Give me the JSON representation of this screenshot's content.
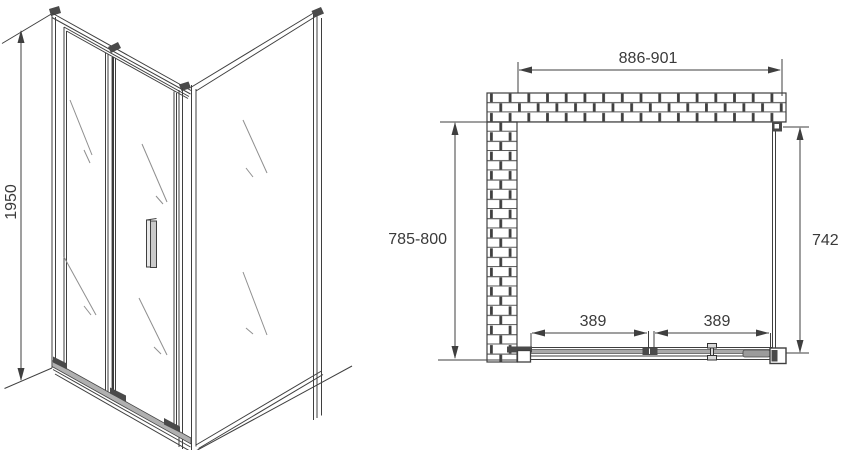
{
  "front_view": {
    "height_label": "1950"
  },
  "plan_view": {
    "width_label": "886-901",
    "depth_label": "785-800",
    "side_panel_label": "742",
    "left_door_label": "389",
    "right_door_label": "389"
  },
  "colors": {
    "line": "#3f3f3f",
    "text": "#3a3a3a",
    "rail_gray": "#a9a9a9",
    "dark_fill": "#4a4a4a",
    "glass_reflection": "#8f8f8f",
    "background": "#ffffff"
  }
}
